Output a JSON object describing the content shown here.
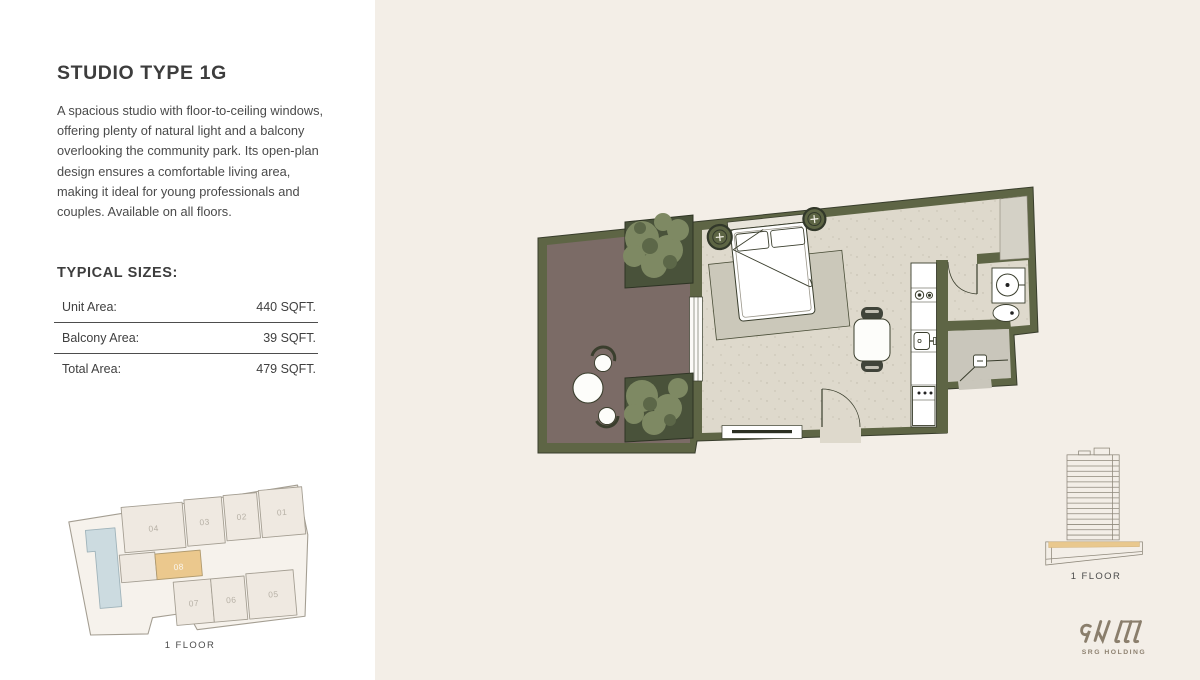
{
  "title": "STUDIO TYPE 1G",
  "description": "A spacious studio with floor-to-ceiling windows, offering plenty of natural light and a balcony overlooking the community park. Its open-plan design ensures a comfortable living area, making it ideal for young professionals and couples. Available on all floors.",
  "typical_sizes": {
    "heading": "TYPICAL SIZES:",
    "rows": [
      {
        "label": "Unit Area:",
        "value": "440 SQFT."
      },
      {
        "label": "Balcony Area:",
        "value": "39 SQFT."
      },
      {
        "label": "Total Area:",
        "value": "479 SQFT."
      }
    ]
  },
  "key_plan": {
    "floor_label": "1 FLOOR",
    "highlighted_unit": "08",
    "units": [
      "04",
      "03",
      "02",
      "01",
      "08",
      "07",
      "06",
      "05"
    ]
  },
  "elevation": {
    "floor_label": "1 FLOOR"
  },
  "brand": {
    "name": "SRG HOLDING"
  },
  "colors": {
    "panel_bg": "#f3eee7",
    "wall_olive": "#5e6545",
    "balcony_floor": "#7b6b66",
    "living_floor": "#ded9cc",
    "entry_floor": "#c9c6bb",
    "accent_tan": "#ebc88d",
    "pool_blue": "#ccdbe0",
    "foliage_green": "#7e8963",
    "brand_brown": "#8a7e6c",
    "text": "#4a4a4a"
  }
}
